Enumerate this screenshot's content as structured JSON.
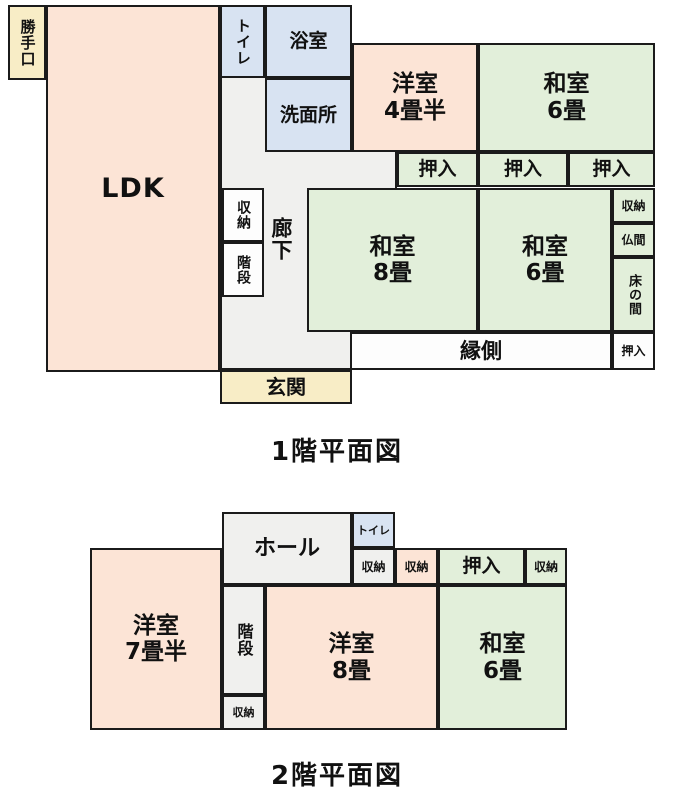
{
  "colors": {
    "wall": "#1b1b1b",
    "text": "#111111",
    "western_room": "#fce4d6",
    "japanese_room": "#e2efda",
    "wet_area": "#d8e3f2",
    "entrance": "#f8edc6",
    "hallway": "#f0f0ee",
    "plain": "#fdfdfd"
  },
  "floor1": {
    "caption": "1階平面図",
    "rooms": {
      "katteguchi": "勝手口",
      "ldk": "LDK",
      "toilet": "トイレ",
      "bath": "浴室",
      "washroom": "洗面所",
      "western45": {
        "name": "洋室",
        "size": "4畳半"
      },
      "japanese6_ne": {
        "name": "和室",
        "size": "6畳"
      },
      "oshiire1": "押入",
      "oshiire2": "押入",
      "oshiire3": "押入",
      "stair_storage": "収納",
      "stairs": "階段",
      "corridor": "廊下",
      "japanese8": {
        "name": "和室",
        "size": "8畳"
      },
      "japanese6_center": {
        "name": "和室",
        "size": "6畳"
      },
      "storage_right": "収納",
      "butsuma": "仏間",
      "tokonoma": "床の間",
      "engawa": "縁側",
      "oshiire4": "押入",
      "genkan": "玄関"
    }
  },
  "floor2": {
    "caption": "2階平面図",
    "rooms": {
      "hall": "ホール",
      "toilet": "トイレ",
      "storage_a": "収納",
      "storage_b": "収納",
      "oshiire": "押入",
      "storage_c": "収納",
      "western75": {
        "name": "洋室",
        "size": "7畳半"
      },
      "stairs": "階段",
      "storage_d": "収納",
      "western8": {
        "name": "洋室",
        "size": "8畳"
      },
      "japanese6": {
        "name": "和室",
        "size": "6畳"
      }
    }
  }
}
